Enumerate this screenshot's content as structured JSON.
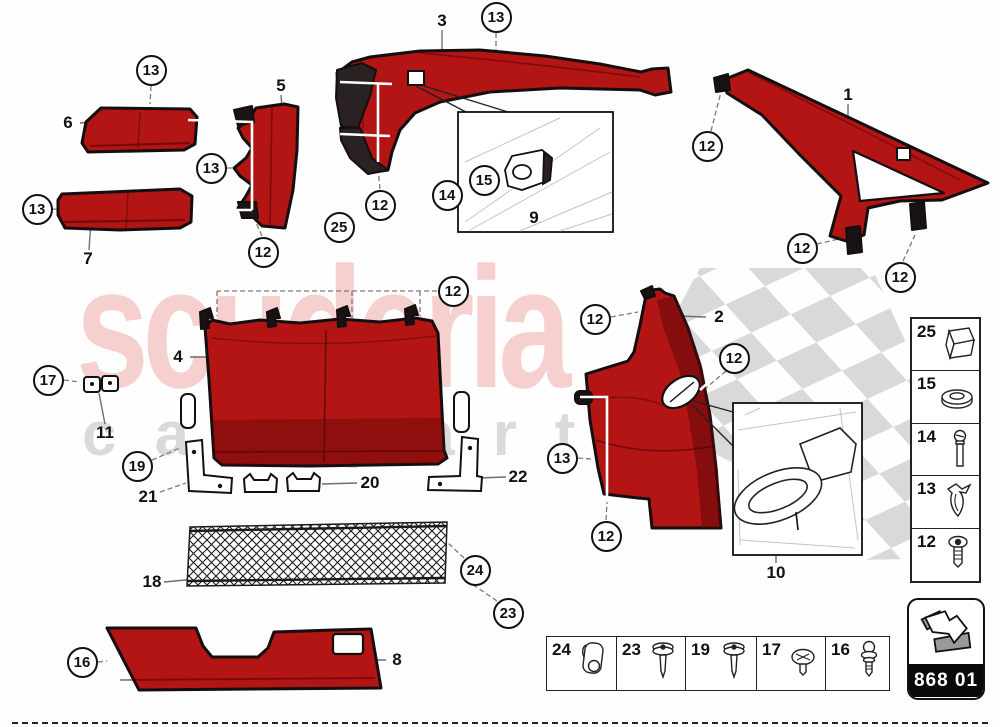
{
  "watermark": {
    "line1": "scuderia",
    "line2": "car parts"
  },
  "callouts": [
    {
      "n": "13",
      "x": 151,
      "y": 70
    },
    {
      "n": "13",
      "x": 37,
      "y": 209
    },
    {
      "n": "13",
      "x": 211,
      "y": 168
    },
    {
      "n": "12",
      "x": 263,
      "y": 252
    },
    {
      "n": "25",
      "x": 339,
      "y": 227
    },
    {
      "n": "12",
      "x": 380,
      "y": 205
    },
    {
      "n": "14",
      "x": 447,
      "y": 195
    },
    {
      "n": "15",
      "x": 484,
      "y": 180
    },
    {
      "n": "13",
      "x": 496,
      "y": 17
    },
    {
      "n": "12",
      "x": 707,
      "y": 146
    },
    {
      "n": "12",
      "x": 802,
      "y": 248
    },
    {
      "n": "12",
      "x": 900,
      "y": 277
    },
    {
      "n": "12",
      "x": 453,
      "y": 291
    },
    {
      "n": "17",
      "x": 48,
      "y": 380
    },
    {
      "n": "19",
      "x": 137,
      "y": 466
    },
    {
      "n": "12",
      "x": 595,
      "y": 319
    },
    {
      "n": "12",
      "x": 734,
      "y": 358
    },
    {
      "n": "13",
      "x": 562,
      "y": 458
    },
    {
      "n": "12",
      "x": 606,
      "y": 536
    },
    {
      "n": "24",
      "x": 475,
      "y": 570
    },
    {
      "n": "23",
      "x": 508,
      "y": 613
    },
    {
      "n": "16",
      "x": 82,
      "y": 662
    }
  ],
  "labels": [
    {
      "n": "6",
      "x": 68,
      "y": 123
    },
    {
      "n": "7",
      "x": 88,
      "y": 259
    },
    {
      "n": "5",
      "x": 281,
      "y": 86
    },
    {
      "n": "3",
      "x": 442,
      "y": 21
    },
    {
      "n": "9",
      "x": 534,
      "y": 218
    },
    {
      "n": "1",
      "x": 848,
      "y": 95
    },
    {
      "n": "2",
      "x": 719,
      "y": 317
    },
    {
      "n": "4",
      "x": 178,
      "y": 357
    },
    {
      "n": "11",
      "x": 105,
      "y": 433
    },
    {
      "n": "21",
      "x": 148,
      "y": 497
    },
    {
      "n": "20",
      "x": 370,
      "y": 483
    },
    {
      "n": "22",
      "x": 518,
      "y": 477
    },
    {
      "n": "18",
      "x": 152,
      "y": 582
    },
    {
      "n": "8",
      "x": 397,
      "y": 660
    },
    {
      "n": "10",
      "x": 776,
      "y": 573
    }
  ],
  "legend": {
    "rows": [
      {
        "number": "25",
        "icon": "foam-block"
      },
      {
        "number": "15",
        "icon": "washer"
      },
      {
        "number": "14",
        "icon": "long-screw"
      },
      {
        "number": "13",
        "icon": "spring-clip"
      },
      {
        "number": "12",
        "icon": "push-rivet"
      }
    ]
  },
  "fastener_table": {
    "cells": [
      {
        "number": "24",
        "icon": "clamp-clip"
      },
      {
        "number": "23",
        "icon": "flange-screw"
      },
      {
        "number": "19",
        "icon": "flange-screw"
      },
      {
        "number": "17",
        "icon": "dome-screw"
      },
      {
        "number": "16",
        "icon": "ball-stud"
      }
    ]
  },
  "badge": {
    "code": "868 01",
    "icon": "arrow-down-right"
  },
  "colors": {
    "part_red": "#b31414",
    "part_red_dark": "#7e0c10",
    "outline": "#140e0e",
    "checker_gray": "#d9d9d9",
    "watermark_pink": "#efa8a8",
    "leader_gray": "#6f6f6f",
    "orange_tip": "#e9965e"
  }
}
